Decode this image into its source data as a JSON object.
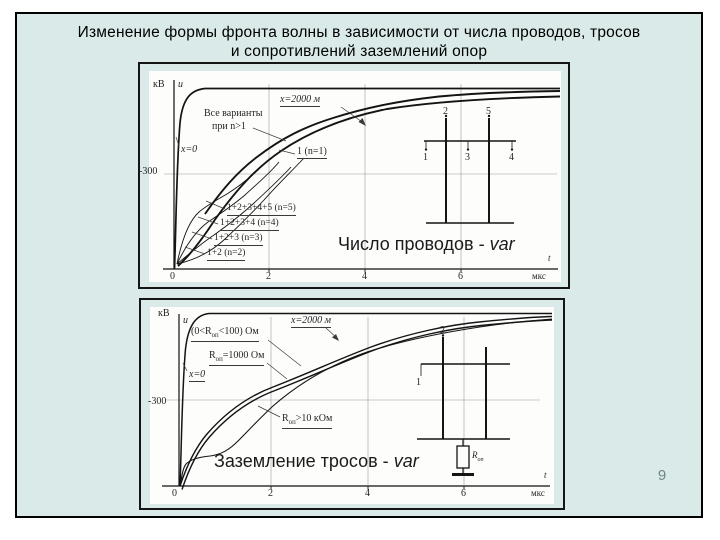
{
  "title": {
    "line1": "Изменение формы фронта волны в зависимости от числа проводов, тросов",
    "line2": "и сопротивлений заземлений опор"
  },
  "page": {
    "number": "9"
  },
  "colors": {
    "slide_bg": "#d9eae8",
    "slide_border": "#000000",
    "figure_frame": "#151515",
    "figure_bg": "#fdfdfc",
    "caption_text": "#1b1b1b",
    "page_number": "#708585",
    "gridline": "#9c9c9c",
    "curve": "#141414"
  },
  "figure1": {
    "caption": {
      "prefix": "Число проводов - ",
      "suffix": "var"
    },
    "labels": [
      {
        "name": "y-axis-unit",
        "text": "кВ",
        "x": 4,
        "y": 9,
        "fs": 10
      },
      {
        "name": "y-axis-var",
        "text": "u",
        "x": 29,
        "y": 9,
        "fs": 10,
        "italic": true
      },
      {
        "name": "label-x2000",
        "text": "x=2000 м",
        "x": 131,
        "y": 24,
        "fs": 10,
        "italic": true,
        "underline": true
      },
      {
        "name": "label-all-variants-line1",
        "text": "Все варианты",
        "x": 55,
        "y": 38,
        "fs": 10
      },
      {
        "name": "label-all-variants-line2",
        "text": "при n>1",
        "x": 63,
        "y": 51,
        "fs": 10
      },
      {
        "name": "label-x0",
        "text": "x=0",
        "x": 32,
        "y": 74,
        "fs": 10,
        "italic": true
      },
      {
        "name": "label-n1",
        "text": "1 (n=1)",
        "x": 148,
        "y": 76,
        "fs": 10,
        "underline": true
      },
      {
        "name": "ytick-minus300",
        "text": "-300",
        "x": -10,
        "y": 96,
        "fs": 10
      },
      {
        "name": "label-n5",
        "text": "1+2+3+4+5 (n=5)",
        "x": 78,
        "y": 133,
        "fs": 9.5,
        "underline": true
      },
      {
        "name": "label-n4",
        "text": "1+2+3+4 (n=4)",
        "x": 71,
        "y": 148,
        "fs": 9.5,
        "underline": true
      },
      {
        "name": "label-n3",
        "text": "1+2+3  (n=3)",
        "x": 65,
        "y": 163,
        "fs": 9.5,
        "underline": true
      },
      {
        "name": "label-n2",
        "text": "1+2 (n=2)",
        "x": 58,
        "y": 178,
        "fs": 9.5,
        "underline": true
      },
      {
        "name": "xtick-0",
        "text": "0",
        "x": 21,
        "y": 201,
        "fs": 10
      },
      {
        "name": "xtick-2",
        "text": "2",
        "x": 117,
        "y": 201,
        "fs": 10
      },
      {
        "name": "xtick-4",
        "text": "4",
        "x": 213,
        "y": 201,
        "fs": 10
      },
      {
        "name": "xtick-6",
        "text": "6",
        "x": 309,
        "y": 201,
        "fs": 10
      },
      {
        "name": "x-axis-unit",
        "text": "мкс",
        "x": 383,
        "y": 201,
        "fs": 9
      },
      {
        "name": "x-axis-var",
        "text": "t",
        "x": 399,
        "y": 183,
        "fs": 9,
        "italic": true
      },
      {
        "name": "tower-wire-2",
        "text": "2",
        "x": 294,
        "y": 36,
        "fs": 10
      },
      {
        "name": "tower-wire-5",
        "text": "5",
        "x": 337,
        "y": 36,
        "fs": 10
      },
      {
        "name": "tower-wire-1",
        "text": "1",
        "x": 274,
        "y": 82,
        "fs": 10
      },
      {
        "name": "tower-wire-3",
        "text": "3",
        "x": 316,
        "y": 82,
        "fs": 10
      },
      {
        "name": "tower-wire-4",
        "text": "4",
        "x": 360,
        "y": 82,
        "fs": 10
      }
    ]
  },
  "figure2": {
    "caption": {
      "prefix": "Заземление тросов - ",
      "suffix": "var"
    },
    "labels": [
      {
        "name": "y-axis-unit",
        "text": "кВ",
        "x": 8,
        "y": 2,
        "fs": 10
      },
      {
        "name": "y-axis-var",
        "text": "u",
        "x": 33,
        "y": 9,
        "fs": 10,
        "italic": true
      },
      {
        "name": "label-x2000",
        "text": "x=2000 м",
        "x": 141,
        "y": 9,
        "fs": 10,
        "italic": true,
        "underline": true
      },
      {
        "name": "label-r-0-100",
        "text": "(0<R~оп~<100) Ом",
        "x": 41,
        "y": 20,
        "fs": 10,
        "underline": true
      },
      {
        "name": "label-r-1000",
        "text": "R~оп~=1000 Ом",
        "x": 59,
        "y": 44,
        "fs": 10,
        "underline": true
      },
      {
        "name": "label-x0",
        "text": "x=0",
        "x": 39,
        "y": 63,
        "fs": 10,
        "italic": true,
        "underline": true
      },
      {
        "name": "ytick-minus300",
        "text": "-300",
        "x": -2,
        "y": 90,
        "fs": 10
      },
      {
        "name": "label-r-10k",
        "text": "R~оп~>10 кОм",
        "x": 132,
        "y": 107,
        "fs": 10,
        "underline": true
      },
      {
        "name": "xtick-0",
        "text": "0",
        "x": 22,
        "y": 182,
        "fs": 10
      },
      {
        "name": "xtick-2",
        "text": "2",
        "x": 118,
        "y": 182,
        "fs": 10
      },
      {
        "name": "xtick-4",
        "text": "4",
        "x": 215,
        "y": 182,
        "fs": 10
      },
      {
        "name": "xtick-6",
        "text": "6",
        "x": 311,
        "y": 182,
        "fs": 10
      },
      {
        "name": "x-axis-unit",
        "text": "мкс",
        "x": 381,
        "y": 182,
        "fs": 9
      },
      {
        "name": "x-axis-var",
        "text": "t",
        "x": 394,
        "y": 164,
        "fs": 9,
        "italic": true
      },
      {
        "name": "tower-wire-2",
        "text": "2",
        "x": 290,
        "y": 19,
        "fs": 10
      },
      {
        "name": "tower-wire-1",
        "text": "1",
        "x": 266,
        "y": 71,
        "fs": 10
      },
      {
        "name": "tower-resistor-label",
        "text": "R~оп~",
        "x": 322,
        "y": 144,
        "fs": 9,
        "italic": true
      }
    ]
  },
  "chart_data": [
    {
      "type": "line",
      "title": "Число проводов - var",
      "xlabel": "t, мкс",
      "ylabel": "u, кВ",
      "x_ticks": [
        0,
        2,
        4,
        6
      ],
      "y_tick_labels": [
        "-300"
      ],
      "x_range": [
        0,
        8
      ],
      "y_range": [
        0,
        -600
      ],
      "grid": true,
      "legend_position": "inline-annotations",
      "annotations": [
        "x=2000 м",
        "Все варианты при n>1",
        "x=0",
        "1 (n=1)",
        "1+2+3+4+5 (n=5)",
        "1+2+3+4 (n=4)",
        "1+2+3 (n=3)",
        "1+2 (n=2)"
      ],
      "x": [
        0,
        0.25,
        0.5,
        1,
        1.5,
        2,
        3,
        4,
        5,
        6,
        7,
        8
      ],
      "series": [
        {
          "name": "x=0",
          "values": [
            0,
            -430,
            -545,
            -560,
            -560,
            -560,
            -560,
            -560,
            -560,
            -560,
            -560,
            -560
          ]
        },
        {
          "name": "1 (n=1)",
          "values": [
            0,
            -40,
            -90,
            -195,
            -270,
            -320,
            -400,
            -455,
            -495,
            -520,
            -535,
            -545
          ]
        },
        {
          "name": "1+2 (n=2)",
          "values": [
            0,
            -45,
            -95,
            -215,
            -305,
            -385,
            -455,
            -500,
            -525,
            -540,
            -548,
            -552
          ]
        },
        {
          "name": "1+2+3 (n=3)",
          "values": [
            0,
            -75,
            -140,
            -245,
            -320,
            -385,
            -455,
            -500,
            -525,
            -540,
            -548,
            -552
          ]
        },
        {
          "name": "1+2+3+4 (n=4)",
          "values": [
            0,
            -110,
            -175,
            -270,
            -330,
            -385,
            -455,
            -500,
            -525,
            -540,
            -548,
            -552
          ]
        },
        {
          "name": "1+2+3+4+5 (n=5)",
          "values": [
            0,
            -150,
            -205,
            -285,
            -340,
            -385,
            -455,
            -500,
            -525,
            -540,
            -548,
            -552
          ]
        }
      ],
      "note": "все варианты при n>1 сходятся в одну кривую"
    },
    {
      "type": "line",
      "title": "Заземление тросов - var",
      "xlabel": "t, мкс",
      "ylabel": "u, кВ",
      "x_ticks": [
        0,
        2,
        4,
        6
      ],
      "y_tick_labels": [
        "-300"
      ],
      "x_range": [
        0,
        8
      ],
      "y_range": [
        0,
        -650
      ],
      "grid": true,
      "legend_position": "inline-annotations",
      "annotations": [
        "x=2000 м",
        "(0<Rоп<100) Ом",
        "Rоп=1000 Ом",
        "x=0",
        "Rоп>10 кОм"
      ],
      "x": [
        0,
        0.25,
        0.5,
        1,
        1.5,
        2,
        3,
        4,
        5,
        6,
        7,
        8
      ],
      "series": [
        {
          "name": "x=0",
          "values": [
            0,
            -470,
            -590,
            -615,
            -615,
            -615,
            -615,
            -615,
            -615,
            -615,
            -615,
            -615
          ]
        },
        {
          "name": "(0<Rоп<100) Ом",
          "values": [
            0,
            -60,
            -105,
            -170,
            -255,
            -335,
            -430,
            -490,
            -540,
            -575,
            -595,
            -610
          ]
        },
        {
          "name": "Rоп=1000 Ом",
          "values": [
            0,
            -55,
            -95,
            -160,
            -240,
            -320,
            -415,
            -478,
            -530,
            -565,
            -588,
            -603
          ]
        },
        {
          "name": "Rоп>10 кОм",
          "values": [
            0,
            -95,
            -105,
            -150,
            -215,
            -280,
            -370,
            -445,
            -500,
            -540,
            -570,
            -590
          ]
        }
      ]
    }
  ]
}
